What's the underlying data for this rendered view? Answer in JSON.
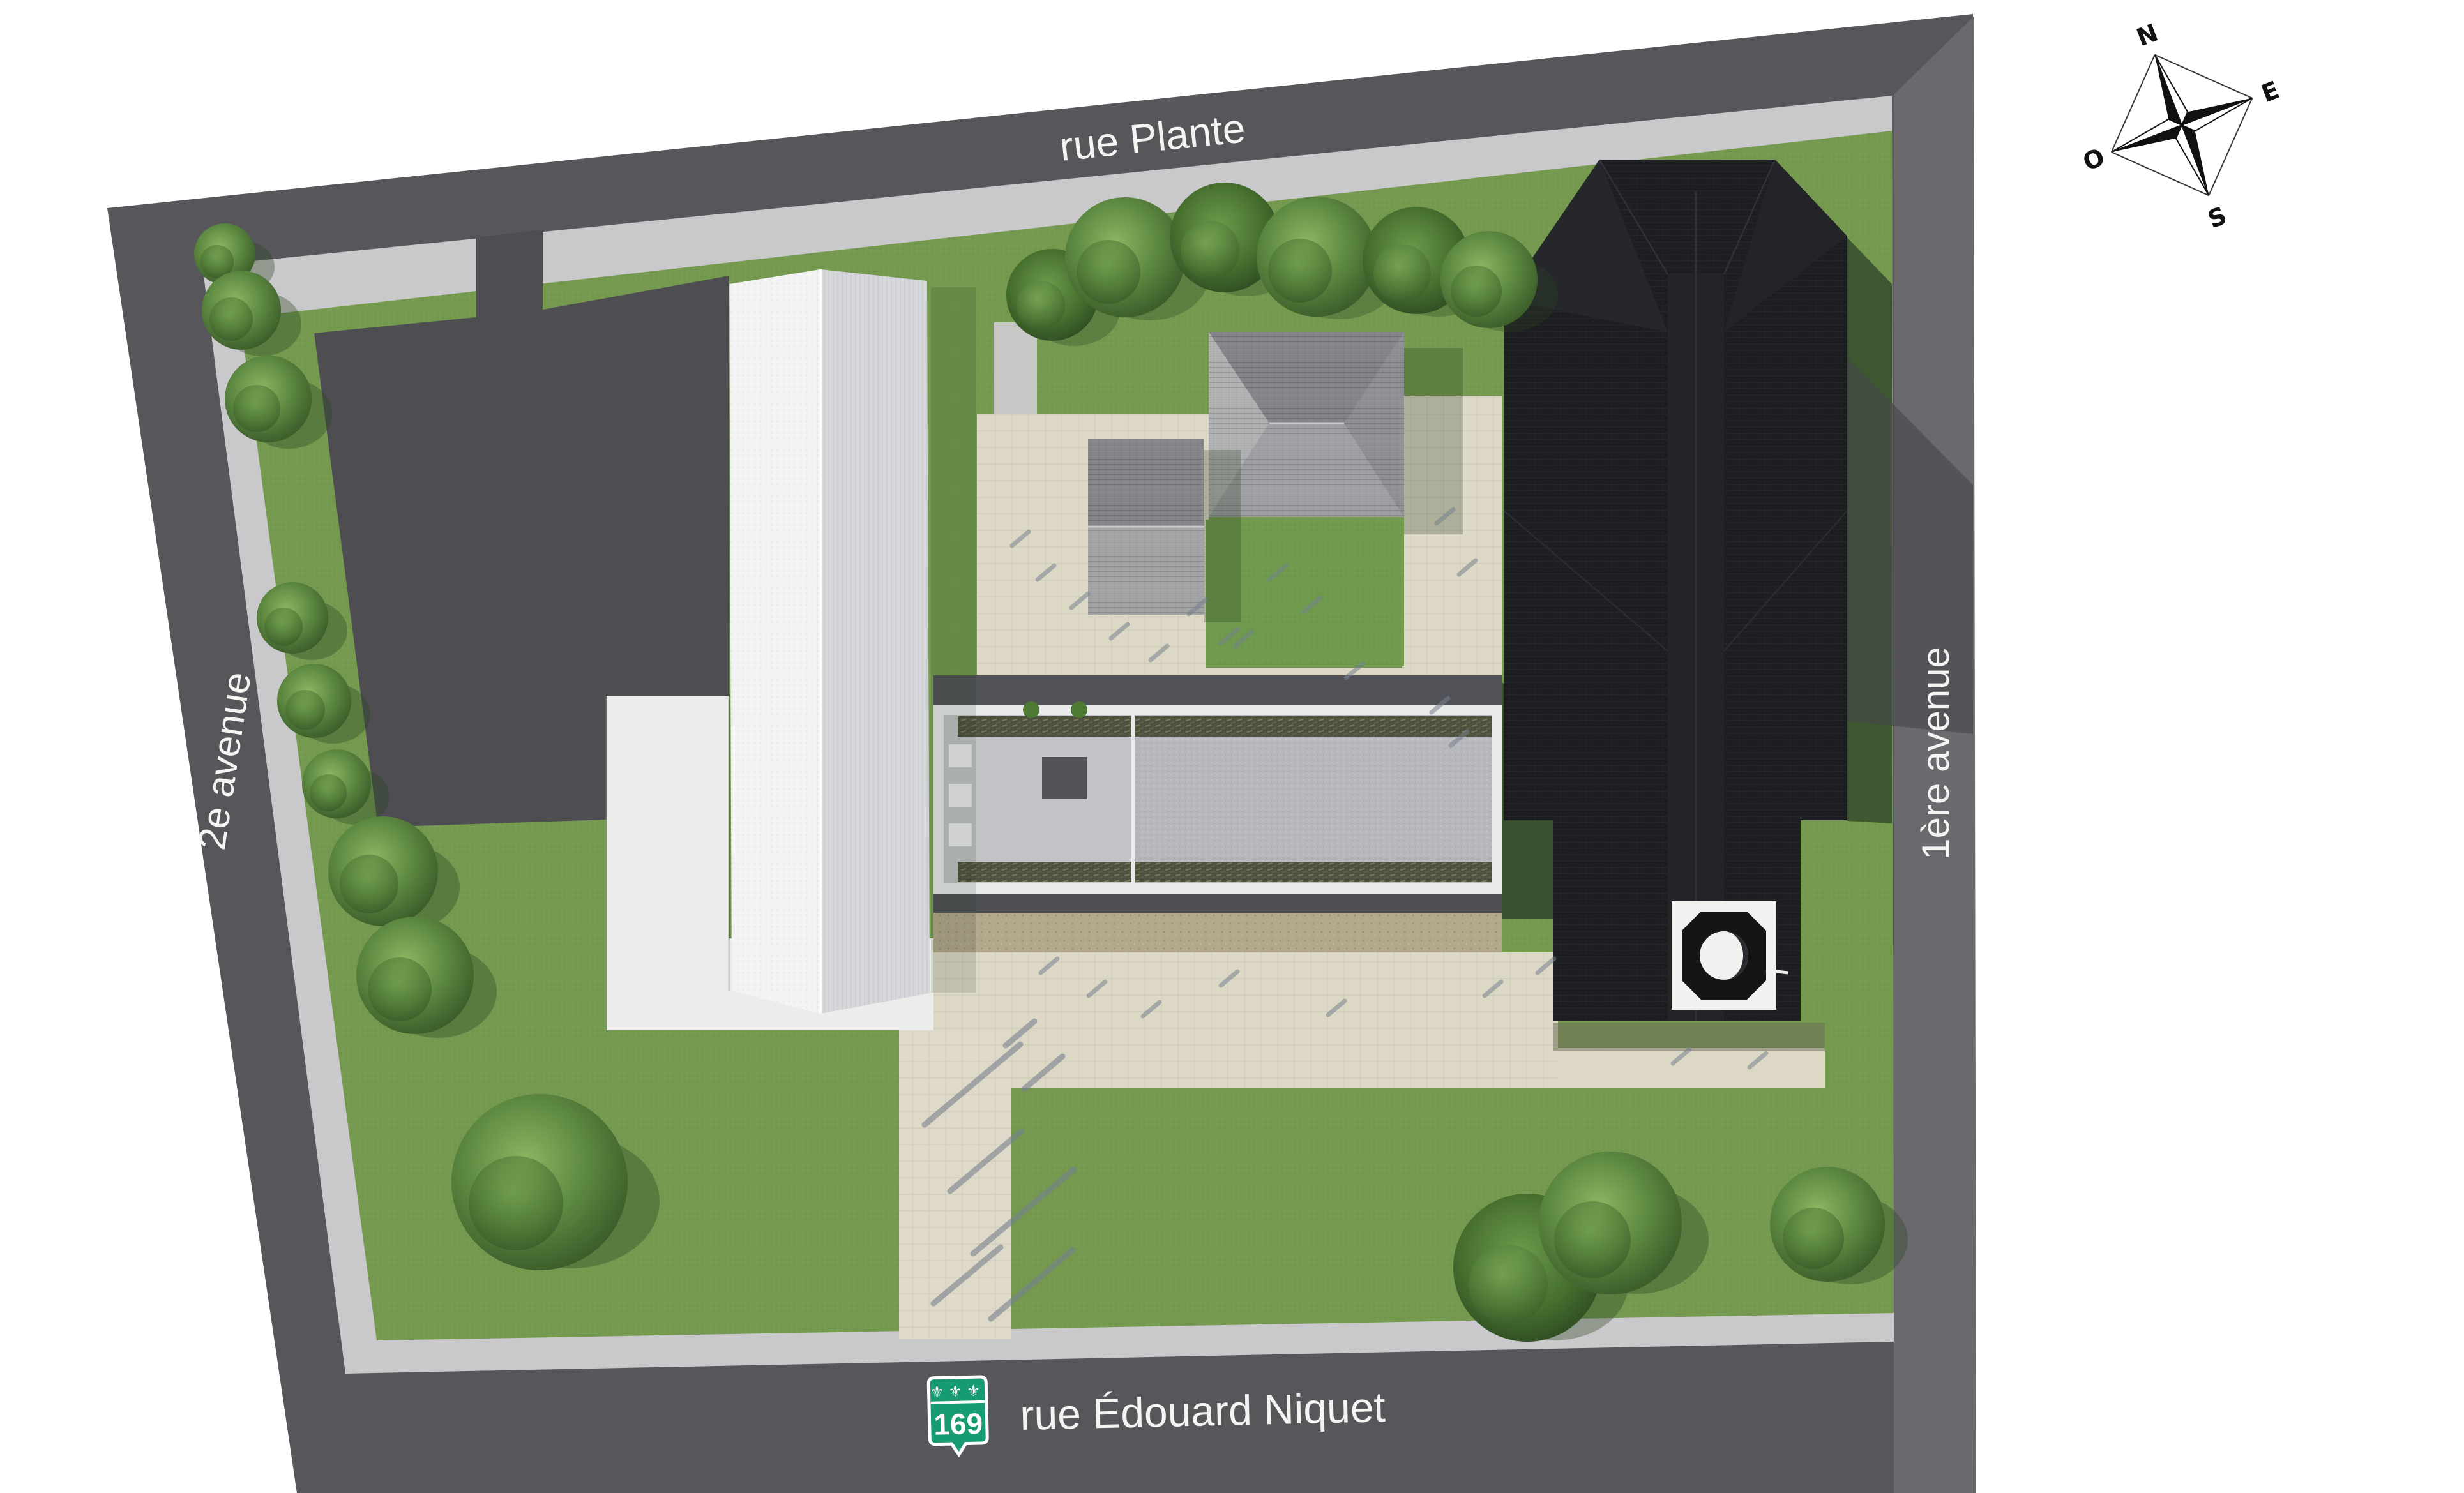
{
  "figure": {
    "streets": {
      "north": "rue Plante",
      "west": "2e avenue",
      "east": "1ère avenue",
      "south": "rue Édouard Niquet"
    },
    "route_shield": {
      "number": "169",
      "fleurs": "⚜⚜⚜",
      "color": "#169b72"
    },
    "compass": {
      "north": "N",
      "east": "E",
      "south": "S",
      "west": "O"
    },
    "colors": {
      "background": "#ffffff",
      "road": "#57565a",
      "road_light": "#6a696d",
      "sidewalk": "#c9c8ca",
      "lawn": "#74994f",
      "parking": "#4e4d51",
      "plaza_beige": "#ddd8c6",
      "gravel": "#b3a78c",
      "building_white": "#f3f3f4",
      "building_shade": "#d5d7db",
      "courtyard_roof": "#b7b8bc",
      "planted_strip": "#4f5040",
      "church_black": "#1d1e21",
      "label_text": "#f4f4f3"
    }
  }
}
